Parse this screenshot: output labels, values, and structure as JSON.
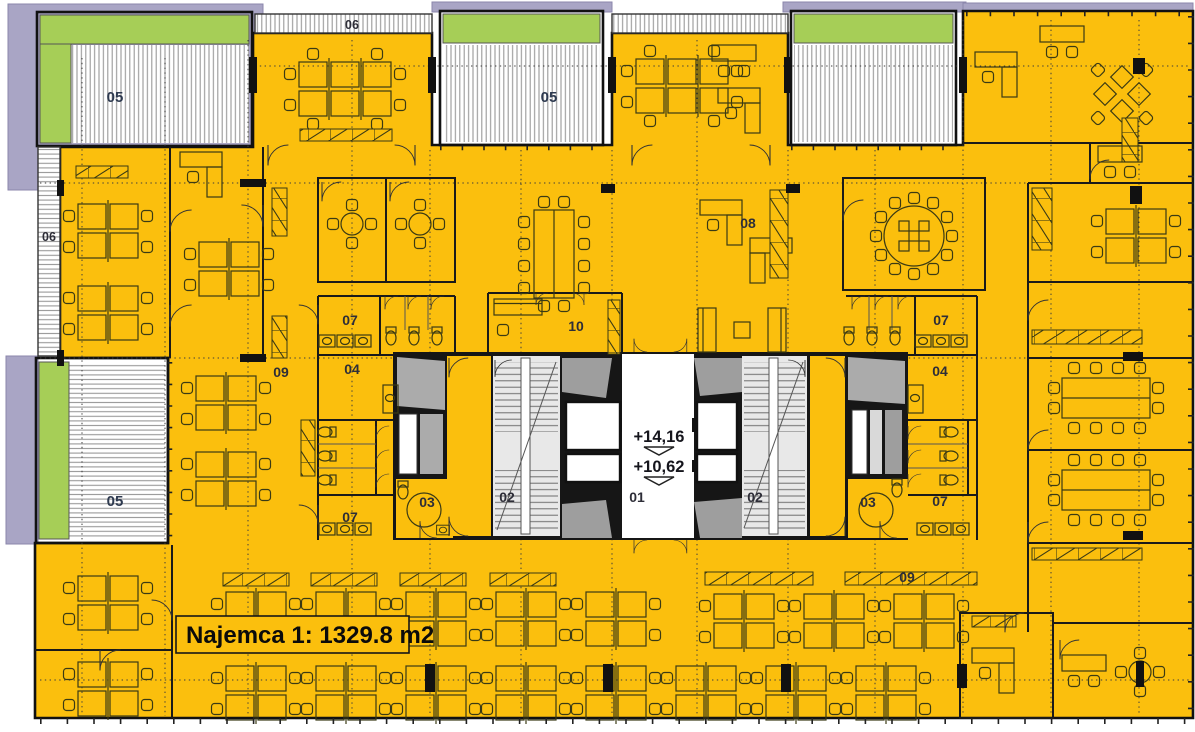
{
  "plan": {
    "tenant": {
      "label": "Najemca 1: 1329.8 m2"
    },
    "levels": {
      "upper": "+14,16",
      "lower": "+10,62"
    },
    "rooms": [
      {
        "number": "05",
        "name": "terrace-northwest"
      },
      {
        "number": "06",
        "name": "balcony-north"
      },
      {
        "number": "05",
        "name": "terrace-north-center"
      },
      {
        "number": "06",
        "name": "balcony-west"
      },
      {
        "number": "08",
        "name": "open-office-08"
      },
      {
        "number": "09",
        "name": "corridor-west"
      },
      {
        "number": "07",
        "name": "restroom-west-upper"
      },
      {
        "number": "04",
        "name": "room-04-west"
      },
      {
        "number": "10",
        "name": "lounge-10"
      },
      {
        "number": "07",
        "name": "restroom-east-upper"
      },
      {
        "number": "04",
        "name": "room-04-east"
      },
      {
        "number": "05",
        "name": "terrace-west"
      },
      {
        "number": "07",
        "name": "restroom-west-lower"
      },
      {
        "number": "03",
        "name": "wc-accessible-west"
      },
      {
        "number": "02",
        "name": "stairwell-west"
      },
      {
        "number": "01",
        "name": "elevator-lobby"
      },
      {
        "number": "02",
        "name": "stairwell-east"
      },
      {
        "number": "03",
        "name": "wc-accessible-east"
      },
      {
        "number": "07",
        "name": "restroom-east-lower"
      },
      {
        "number": "09",
        "name": "corridor-south"
      }
    ],
    "colors": {
      "floor": "#FBBF0D",
      "terrace_green": "#A6CE57",
      "parapet_purple": "#A9A5C5",
      "core_wall": "#161616",
      "shaft_gray": "#ABABAB",
      "stair_gray": "#E8E8E8"
    }
  }
}
